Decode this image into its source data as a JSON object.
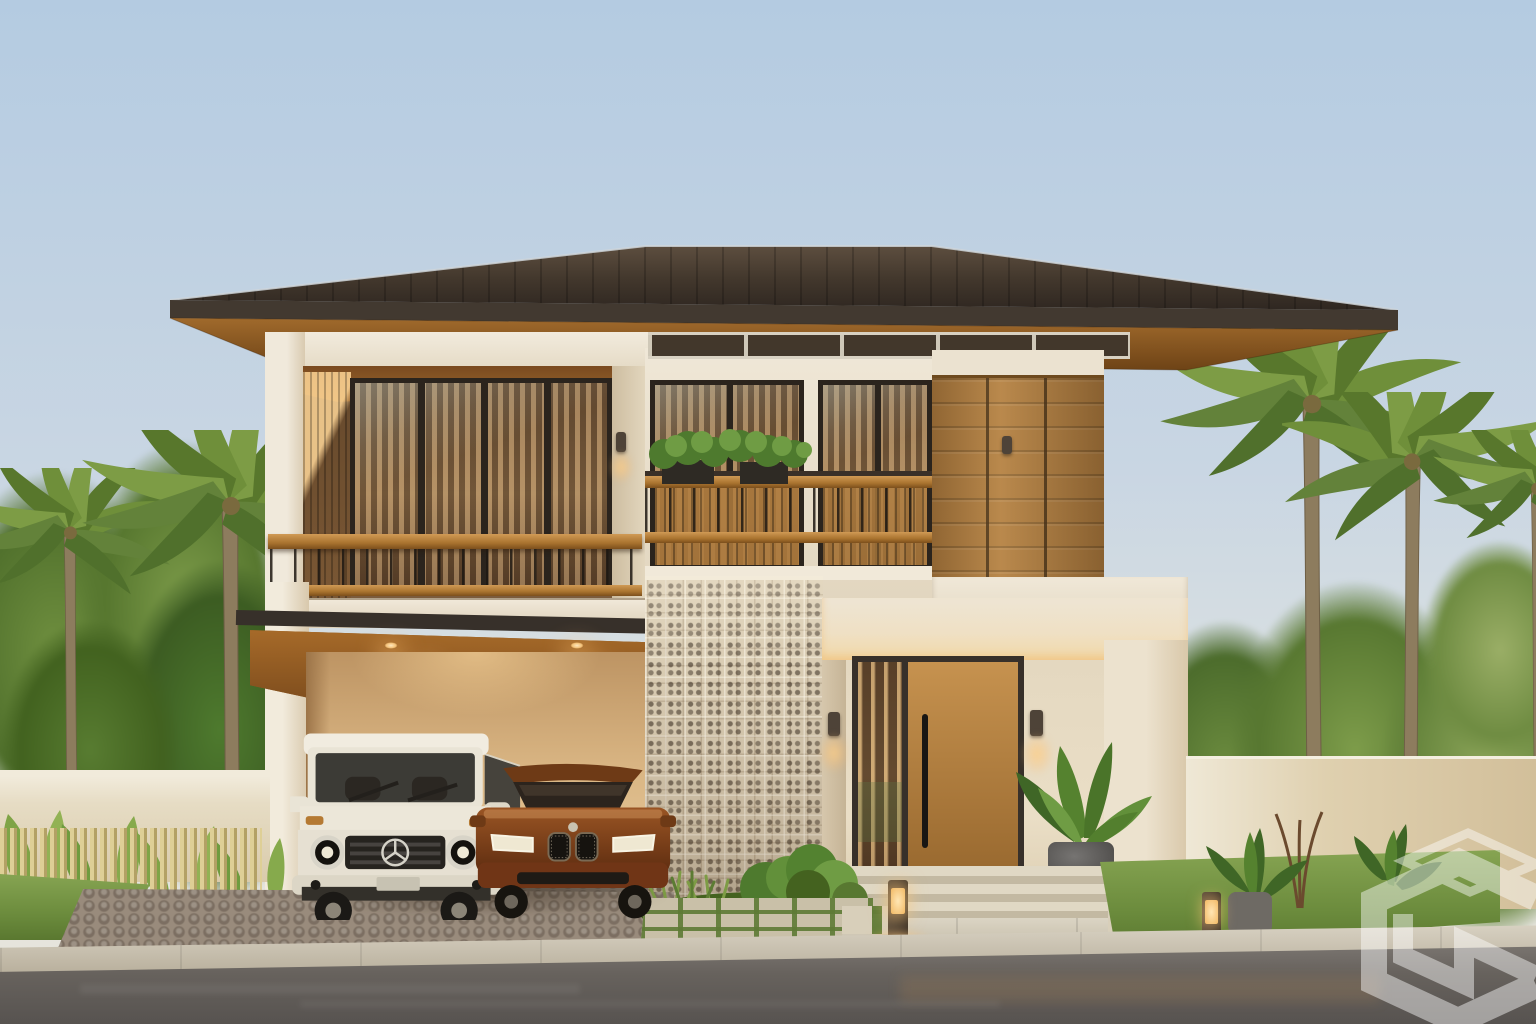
{
  "meta": {
    "title": "Photorealistic dusk rendering of a modern tropical two-storey house with carport, breeze-block screen wall and palm trees",
    "domain": "architectural exterior visualization",
    "time_of_day": "dusk / golden hour"
  },
  "palette": {
    "skyTop": "#b4cbe1",
    "skyLow": "#e9e5da",
    "roofDark": "#2f2721",
    "roofLight": "#5d4e3f",
    "roofFascia": "#423930",
    "soffitWood": "#8f5c26",
    "wallCream": "#ebe2d0",
    "wallShade": "#d6c5a8",
    "wood": "#b5803d",
    "woodDark": "#8a5a26",
    "frameDark": "#2b241d",
    "glassWarm": "#97744c",
    "breezeBlock": "#d9ccb3",
    "railWood": "#b5773a",
    "grass": "#7d9c48",
    "grassDark": "#4e7a2e",
    "foliage": "#5d7c30",
    "mountain": "#a8a4ad",
    "road": "#6b6662",
    "sidewalk": "#c9bfa9",
    "cobble": "#998b7c",
    "carWhite": "#ece7d9",
    "carBrown": "#7a3c1b",
    "warmGlow": "#f3c178",
    "watermarkWhite": "#ffffff"
  },
  "scene": {
    "house": {
      "label": "two-storey modern tropical house",
      "roof": "dark standing-seam hip roof with wide eaves and wood soffit",
      "upper_floor": [
        "recessed balcony with full-height glazing and wood railing",
        "two tall windows with planter boxes and wood screens",
        "horizontal wood siding volume",
        "clerestory window strip"
      ],
      "ground_floor": [
        "double carport with wood ceiling and downlights",
        "decorative breeze-block screen tower",
        "entry porch with slatted wood pivot door and glass sidelight"
      ]
    },
    "vehicles": [
      {
        "label": "white boxy luxury SUV",
        "position": "carport left"
      },
      {
        "label": "brown luxury sedan",
        "position": "carport right"
      }
    ],
    "lighting": {
      "carport_downlights": 4,
      "wall_sconces": 4,
      "entry_sconces": 2,
      "bollard_path_lights": 2
    },
    "landscape": {
      "palm_trees": 5,
      "background": "dense tropical trees with hazy mountain on the right horizon",
      "perimeter_walls": "low cream stucco walls left and right",
      "front": [
        "banana plants with bamboo picket fence (left)",
        "ornamental grasses and shrubs bed (center)",
        "lawn with stepping stones, potted fern and young tree (right)",
        "cobblestone driveway",
        "grass-jointed paver walkway",
        "concrete sidewalk and asphalt road"
      ]
    },
    "watermark": {
      "label": "isometric cube logo watermark",
      "position": "bottom-right",
      "opacity": 0.45
    }
  }
}
